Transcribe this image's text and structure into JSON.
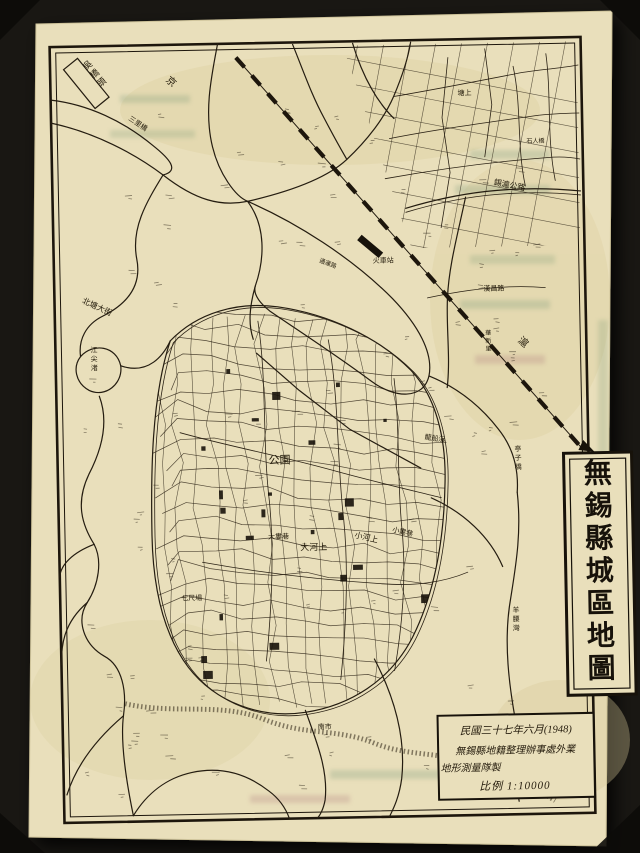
{
  "scene": {
    "backdrop_color": "#191713",
    "paper_color": "#e9dfbb",
    "ink_color": "#241c10"
  },
  "title_box": {
    "text": "無錫縣城區地圖"
  },
  "info_box": {
    "line1": "民國三十七年六月(1948)",
    "line2": "無錫縣地籍整理辦事處外業",
    "line3": "地形測量隊製",
    "scale": "比例 1:10000"
  },
  "labels": [
    {
      "text": "吳橋頭",
      "x": 93,
      "y": 66,
      "size": 9,
      "rotate": -38,
      "vertical": true
    },
    {
      "text": "京",
      "x": 172,
      "y": 78,
      "size": 10,
      "rotate": 42,
      "vertical": false
    },
    {
      "text": "滬",
      "x": 519,
      "y": 345,
      "size": 10,
      "rotate": 42,
      "vertical": false
    },
    {
      "text": "三里橋",
      "x": 134,
      "y": 116,
      "size": 7,
      "rotate": 35,
      "vertical": false
    },
    {
      "text": "北塘大街",
      "x": 84,
      "y": 298,
      "size": 8,
      "rotate": 26,
      "vertical": false
    },
    {
      "text": "江尖渚",
      "x": 92,
      "y": 348,
      "size": 7,
      "rotate": 0,
      "vertical": true
    },
    {
      "text": "塘上",
      "x": 464,
      "y": 98,
      "size": 7,
      "rotate": 0,
      "vertical": false
    },
    {
      "text": "石人橋",
      "x": 532,
      "y": 147,
      "size": 6,
      "rotate": 0,
      "vertical": false
    },
    {
      "text": "錫滬公路",
      "x": 498,
      "y": 188,
      "size": 8,
      "rotate": 12,
      "vertical": false
    },
    {
      "text": "漢昌路",
      "x": 486,
      "y": 294,
      "size": 7,
      "rotate": 0,
      "vertical": false
    },
    {
      "text": "華新里",
      "x": 487,
      "y": 338,
      "size": 6,
      "rotate": 0,
      "vertical": true
    },
    {
      "text": "火車站",
      "x": 376,
      "y": 264,
      "size": 7,
      "rotate": 0,
      "vertical": false
    },
    {
      "text": "通運路",
      "x": 322,
      "y": 262,
      "size": 6,
      "rotate": 22,
      "vertical": false
    },
    {
      "text": "公園",
      "x": 268,
      "y": 463,
      "size": 11,
      "rotate": 0,
      "vertical": false
    },
    {
      "text": "大河上",
      "x": 298,
      "y": 550,
      "size": 9,
      "rotate": 0,
      "vertical": false
    },
    {
      "text": "小河上",
      "x": 352,
      "y": 538,
      "size": 8,
      "rotate": 14,
      "vertical": false
    },
    {
      "text": "大婁巷",
      "x": 266,
      "y": 538,
      "size": 7,
      "rotate": 0,
      "vertical": false
    },
    {
      "text": "小婁巷",
      "x": 390,
      "y": 533,
      "size": 7,
      "rotate": 14,
      "vertical": false
    },
    {
      "text": "七尺場",
      "x": 178,
      "y": 598,
      "size": 7,
      "rotate": 0,
      "vertical": false
    },
    {
      "text": "龍船浜",
      "x": 424,
      "y": 441,
      "size": 7,
      "rotate": 10,
      "vertical": false
    },
    {
      "text": "亭子橋",
      "x": 514,
      "y": 455,
      "size": 7,
      "rotate": 0,
      "vertical": true
    },
    {
      "text": "羊腰灣",
      "x": 509,
      "y": 616,
      "size": 7,
      "rotate": 0,
      "vertical": true
    },
    {
      "text": "南市",
      "x": 312,
      "y": 729,
      "size": 7,
      "rotate": 0,
      "vertical": false
    }
  ]
}
